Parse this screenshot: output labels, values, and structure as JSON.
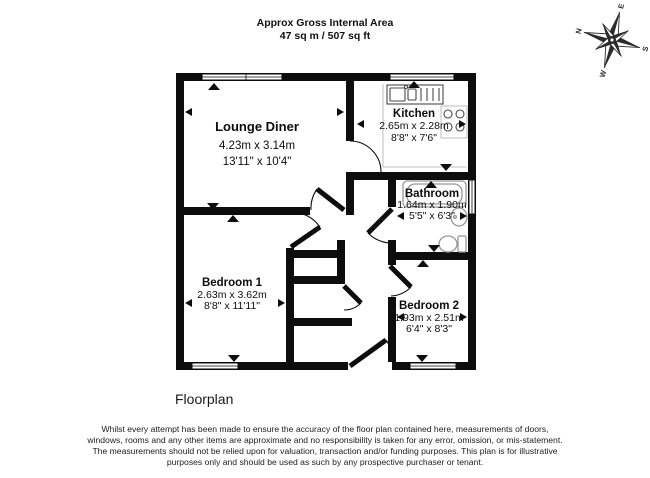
{
  "header": {
    "title": "Approx Gross Internal Area",
    "area": "47 sq m / 507 sq ft"
  },
  "compass": {
    "north": "N",
    "east": "E",
    "south": "S",
    "west": "W"
  },
  "rooms": [
    {
      "name": "Lounge Diner",
      "metric": "4.23m x 3.14m",
      "imperial": "13'11\" x 10'4\""
    },
    {
      "name": "Kitchen",
      "metric": "2.65m x 2.28m",
      "imperial": "8'8\" x 7'6\""
    },
    {
      "name": "Bathroom",
      "metric": "1.64m x 1.90m",
      "imperial": "5'5\" x 6'3\""
    },
    {
      "name": "Bedroom 1",
      "metric": "2.63m x 3.62m",
      "imperial": "8'8\" x 11'11\""
    },
    {
      "name": "Bedroom 2",
      "metric": "1.93m x 2.51m",
      "imperial": "6'4\" x 8'3\""
    }
  ],
  "caption": "Floorplan",
  "disclaimer": "Whilst every attempt has been made to ensure the accuracy of the floor plan contained here, measurements of doors, windows, rooms and any other items are approximate and no responsibility is taken for any error, omission, or mis-statement. The measurements should not be relied upon for valuation, transaction and/or funding purposes. This plan is for illustrative purposes only and should be used as such by any prospective purchaser or tenant.",
  "colors": {
    "wall": "#0d0d0d",
    "fixture": "#979797",
    "accent_counter": "#c2c2c2"
  }
}
